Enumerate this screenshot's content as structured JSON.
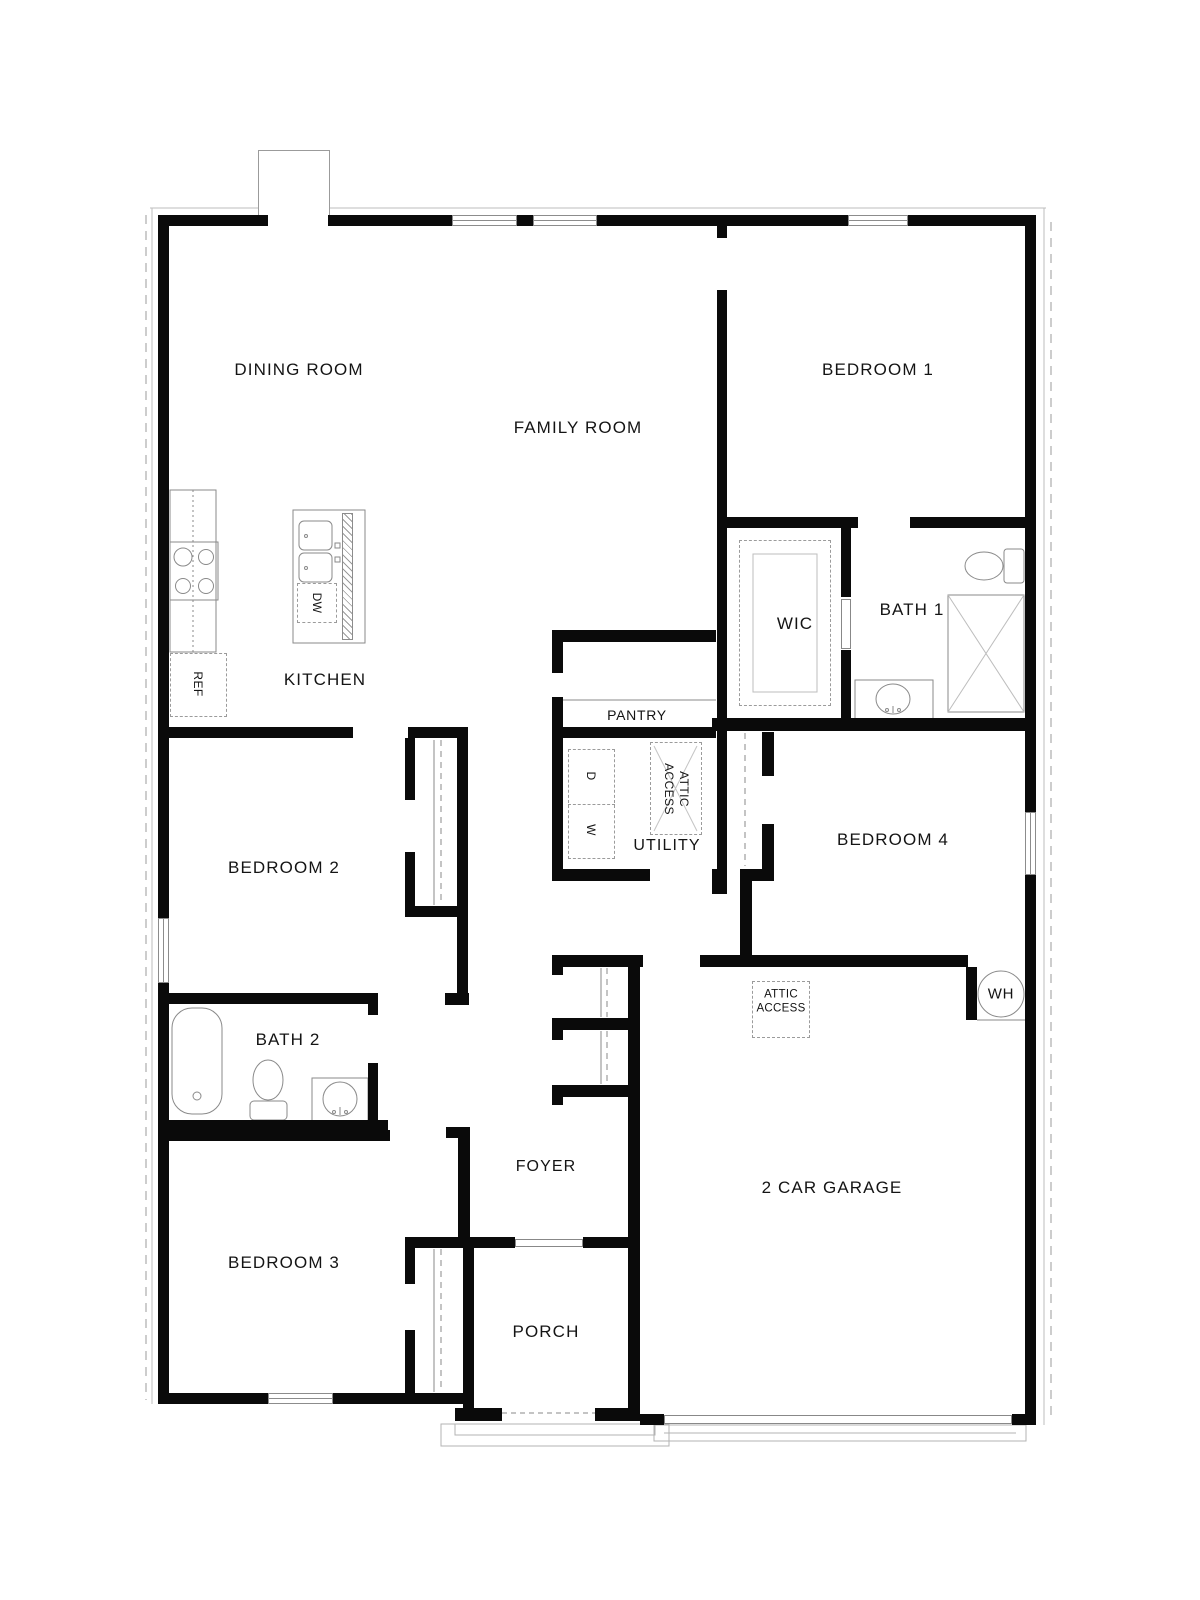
{
  "labels": {
    "dining": "DINING ROOM",
    "family": "FAMILY ROOM",
    "bedroom1": "BEDROOM 1",
    "kitchen": "KITCHEN",
    "wic": "WIC",
    "bath1": "BATH 1",
    "pantry": "PANTRY",
    "utility": "UTILITY",
    "bedroom4": "BEDROOM 4",
    "bedroom2": "BEDROOM 2",
    "bath2": "BATH 2",
    "bedroom3": "BEDROOM 3",
    "foyer": "FOYER",
    "porch": "PORCH",
    "garage": "2 CAR GARAGE",
    "water_heater": "WH",
    "attic_line1": "ATTIC",
    "attic_line2": "ACCESS",
    "refrigerator": "REF",
    "dishwasher": "DW",
    "dryer": "D",
    "washer": "W"
  },
  "colors": {
    "wall": "#0a0a0a",
    "fixture_line": "#8a8a8a",
    "dashed_line": "#9b9b9b",
    "text": "#141414",
    "background": "#ffffff"
  }
}
